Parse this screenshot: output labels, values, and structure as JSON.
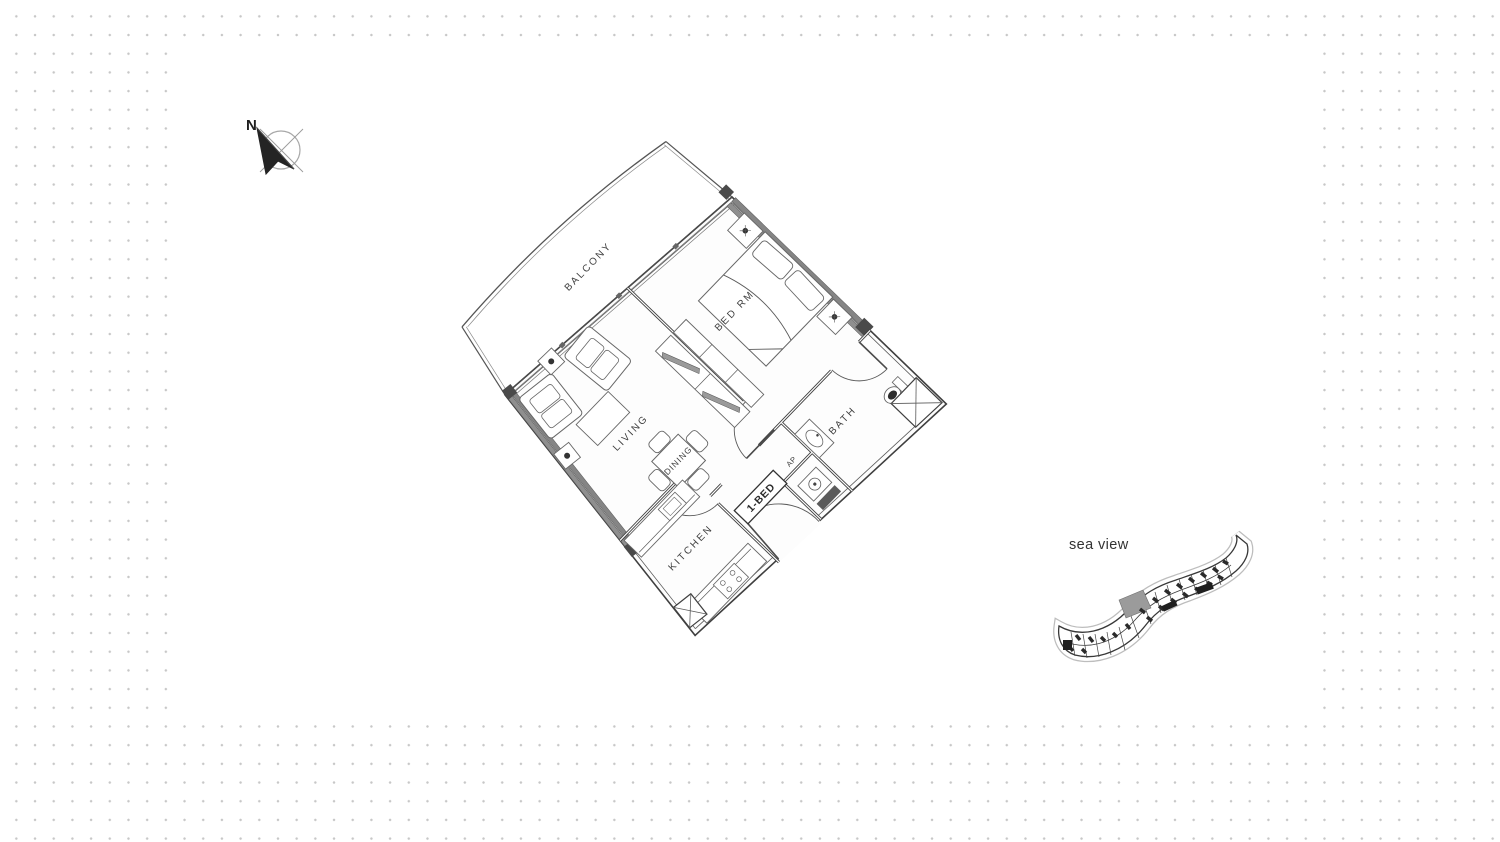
{
  "compass": {
    "north": "N"
  },
  "floor_plan": {
    "labels": {
      "balcony": "BALCONY",
      "bedroom": "BED RM",
      "living": "LIVING",
      "dining": "DINING",
      "kitchen": "KITCHEN",
      "bath": "BATH"
    },
    "unit_tag": "1-BED",
    "utility_tag": "AP"
  },
  "key_plan": {
    "caption": "sea view",
    "highlight_color": "#9b9b9b"
  },
  "style": {
    "dot_color": "#c7c7c7",
    "panel_color": "#ffffff",
    "line_color": "#3f3f3f",
    "glazing_band_color": "#858585"
  }
}
